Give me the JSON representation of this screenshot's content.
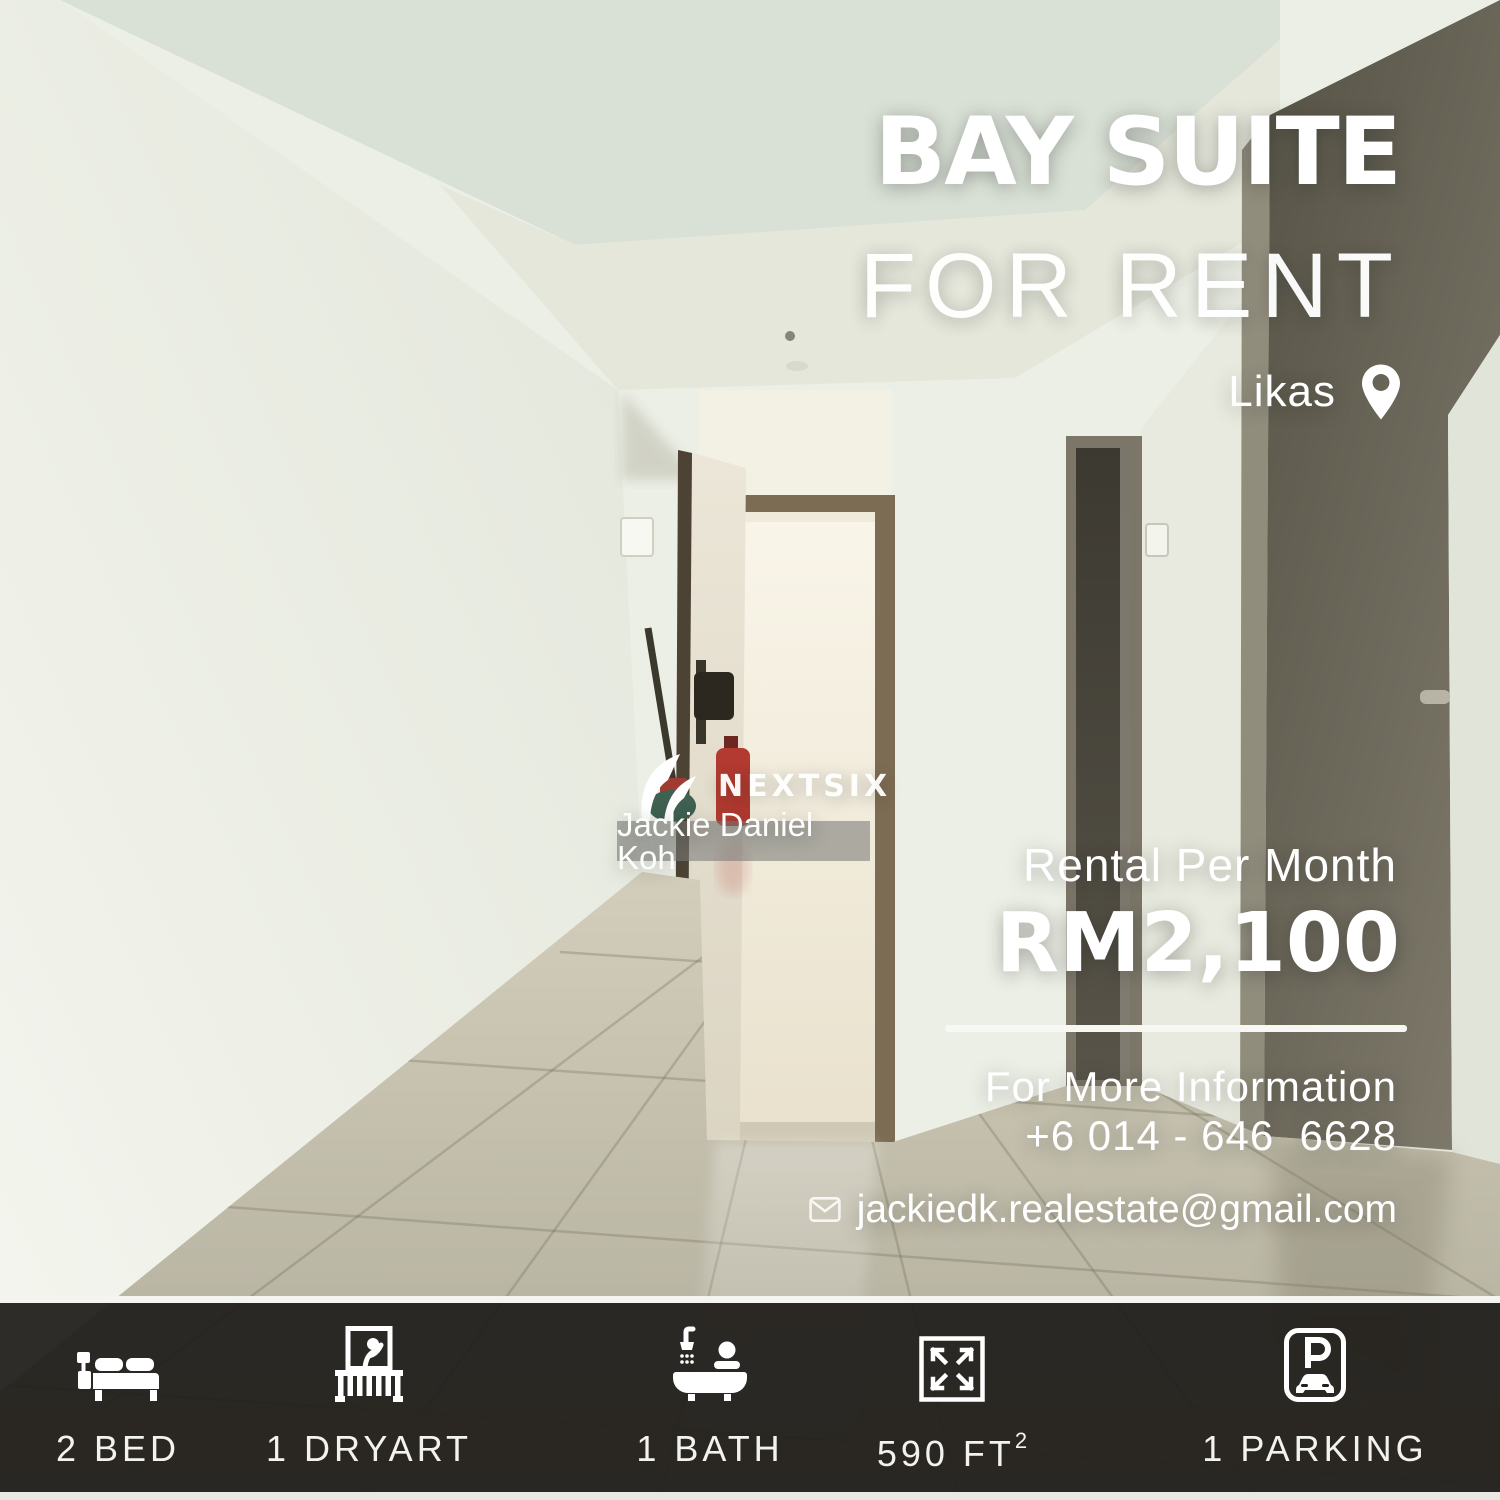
{
  "poster": {
    "title": "BAY SUITE",
    "subtitle": "FOR RENT",
    "location": "Likas",
    "brand": "NEXTSIX",
    "agent": "Jackie Daniel Koh",
    "rental_label": "Rental Per Month",
    "price": "RM2,100",
    "info_label": "For More Information",
    "phone": "+6 014 - 646  6628",
    "email": "jackiedk.realestate@gmail.com"
  },
  "features": [
    {
      "icon": "bed-icon",
      "label": "2 BED",
      "sup": ""
    },
    {
      "icon": "balcony-icon",
      "label": "1 DRYART",
      "sup": ""
    },
    {
      "icon": "bath-icon",
      "label": "1 BATH",
      "sup": ""
    },
    {
      "icon": "area-icon",
      "label": "590 FT",
      "sup": "2"
    },
    {
      "icon": "parking-icon",
      "label": "1 PARKING",
      "sup": ""
    }
  ],
  "colors": {
    "text": "#ffffff",
    "bottom_bar": "#211f1c",
    "divider": "#f7f7f4",
    "extinguisher_red": "#b23a30"
  }
}
